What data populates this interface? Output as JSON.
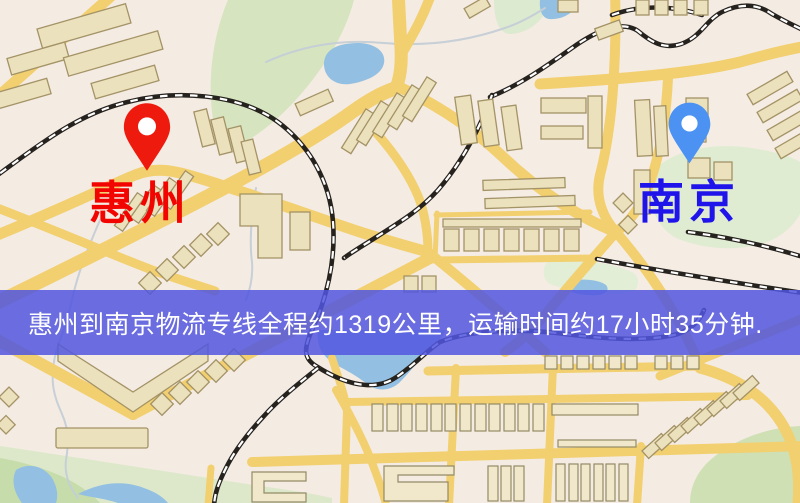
{
  "markers": {
    "origin": {
      "label": "惠州",
      "pin_icon": "red-map-pin-icon",
      "pin_color": "#ee1a0e",
      "label_color": "#f20500"
    },
    "destination": {
      "label": "南京",
      "pin_icon": "blue-map-pin-icon",
      "pin_color": "#4b92f2",
      "label_color": "#1f14ea"
    }
  },
  "banner": {
    "text": "惠州到南京物流专线全程约1319公里，运输时间约17小时35分钟.",
    "origin": "惠州",
    "destination": "南京",
    "distance_km": "1319",
    "duration": "17小时35分钟"
  },
  "theme": {
    "banner_bg": "#5156dfd9",
    "banner_text": "#ffffff",
    "origin_pin": "#ee1a0e",
    "origin_label": "#f20500",
    "destination_pin": "#4b92f2",
    "destination_label": "#1f14ea",
    "map_bg": "#f4ebe2",
    "road": "#f2cf6f",
    "building": "#ece1bd",
    "building_stroke": "#a39366",
    "water": "#93c0e2",
    "park": "#d6e4c0",
    "rail": "#26221e"
  }
}
